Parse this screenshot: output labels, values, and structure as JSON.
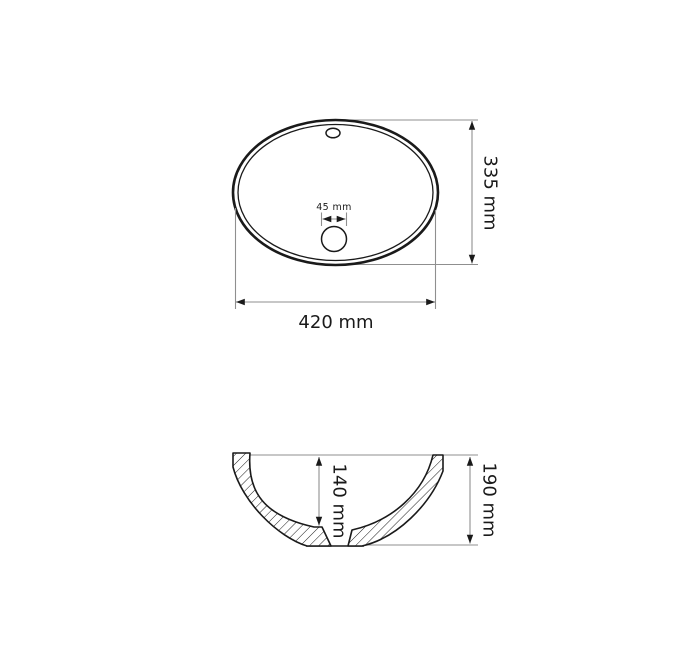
{
  "top_view": {
    "width_dimension": "420 mm",
    "height_dimension": "335 mm",
    "drain_dimension": "45 mm"
  },
  "section_view": {
    "basin_depth_dimension": "140 mm",
    "overall_height_dimension": "190 mm"
  },
  "colors": {
    "outline": "#1a1a1a",
    "dimension_line": "#8f8f8f",
    "background": "#ffffff"
  }
}
